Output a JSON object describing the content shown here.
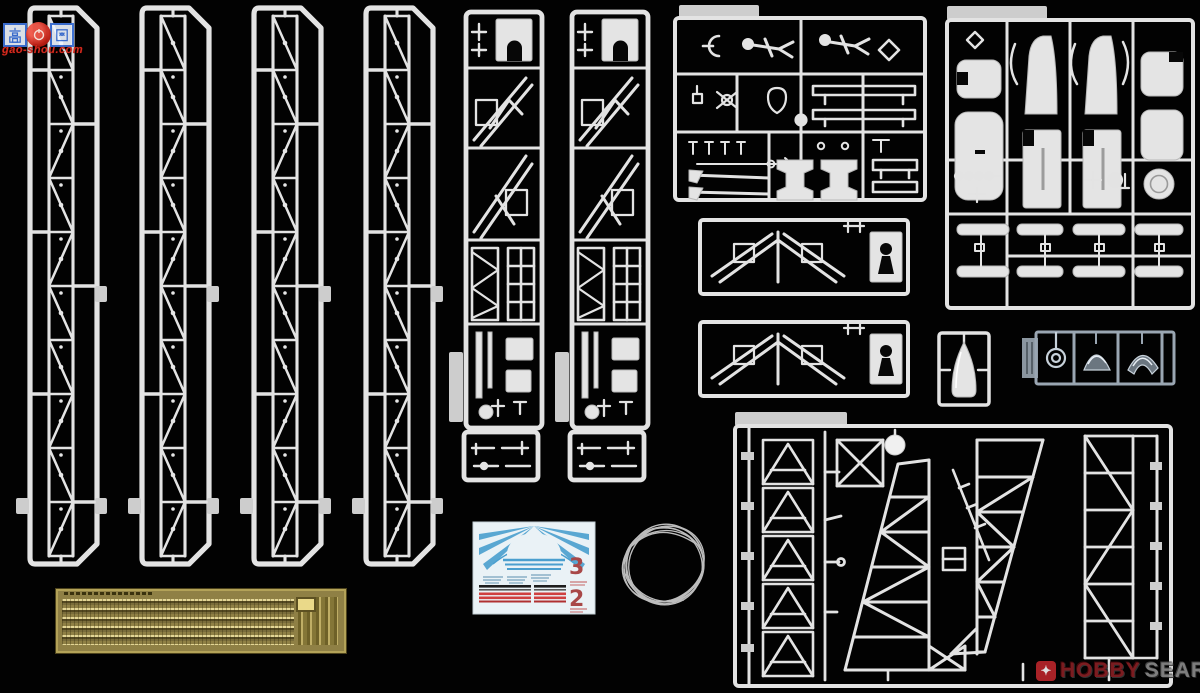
{
  "photo": {
    "subject": "Plastic model kit contents laid out on black: four girder-tower sprues, two lattice mast sprues, fittings and figure sprue, two diagonal brace sprues, rocket fairing sprue, nose-cone sprue, clear-parts sprue, large gantry truss sprue, photo-etched brass fret, waterslide decal sheet and a coil of rigging wire",
    "background_color": "#020202",
    "plastic_color": "#e3e3e3",
    "photo_etch_color": "#8f8045",
    "clear_part_color": "#6b7680"
  },
  "watermark": {
    "left_char": "高",
    "right_char": "网",
    "url_text": "gao-shou.com",
    "text_color": "#d42a1e",
    "box_color": "#3b6fd4"
  },
  "retailer": {
    "brand_word1": "HOBBY",
    "brand_word2": "SEARCH",
    "icon_glyph": "✦",
    "icon_color": "#c0272d",
    "word1_color": "#8c2025",
    "word2_color": "#8f8f8f"
  },
  "decal_sheet": {
    "numeral_top": "3",
    "numeral_bottom": "2",
    "numeral_color": "#a84848",
    "stripe_blue": "#4a9fcf",
    "stripe_red": "#cf4040",
    "stripe_black": "#1d1d1d",
    "paper_color": "#eaf2f6"
  },
  "objects": {
    "girder_sprue_count": 4,
    "mast_sprue_count": 2,
    "brace_sprue_count": 2,
    "items": [
      "tower-girder-sprue x4",
      "lattice-mast-sprue x2",
      "figures-and-fittings-sprue",
      "diagonal-brace-sprue x2",
      "rocket-fairing-sprue",
      "nose-cone-sprue",
      "clear-parts-sprue",
      "gantry-truss-sprue",
      "photo-etched-fret",
      "decal-sheet",
      "wire-coil"
    ]
  }
}
